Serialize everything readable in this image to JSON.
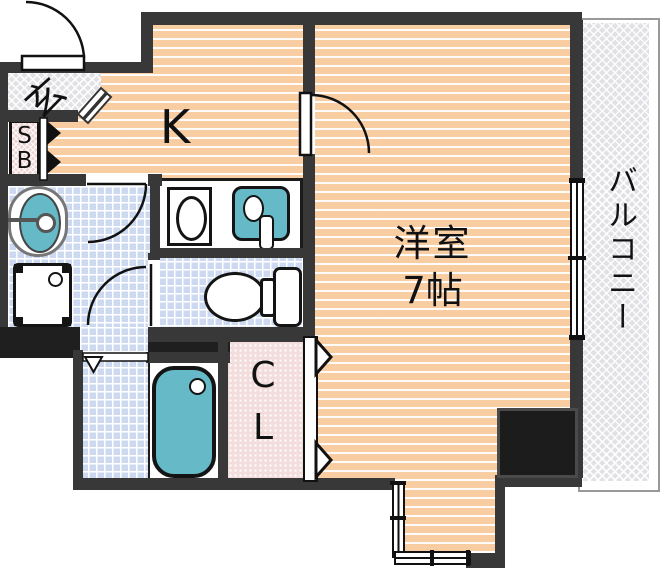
{
  "floorplan": {
    "labels": {
      "entrance": "玄",
      "shoe_box_line1": "S",
      "shoe_box_line2": "B",
      "kitchen": "K",
      "main_room_name": "洋室",
      "main_room_size": "7帖",
      "closet_line1": "C",
      "closet_line2": "L",
      "balcony": "バルコニー"
    },
    "colors": {
      "room_fill_orange": "#F8CDA2",
      "wet_room_tile_blue": "#CDD9F1",
      "fixture_teal": "#66BAC8",
      "wall_gray": "#383838",
      "pillar_black": "#1C1C1C",
      "entrance_hatch_gray": "#E1E1E5",
      "shoe_box_pink": "#F0D4D4",
      "closet_pink": "#F2DCDC"
    }
  }
}
